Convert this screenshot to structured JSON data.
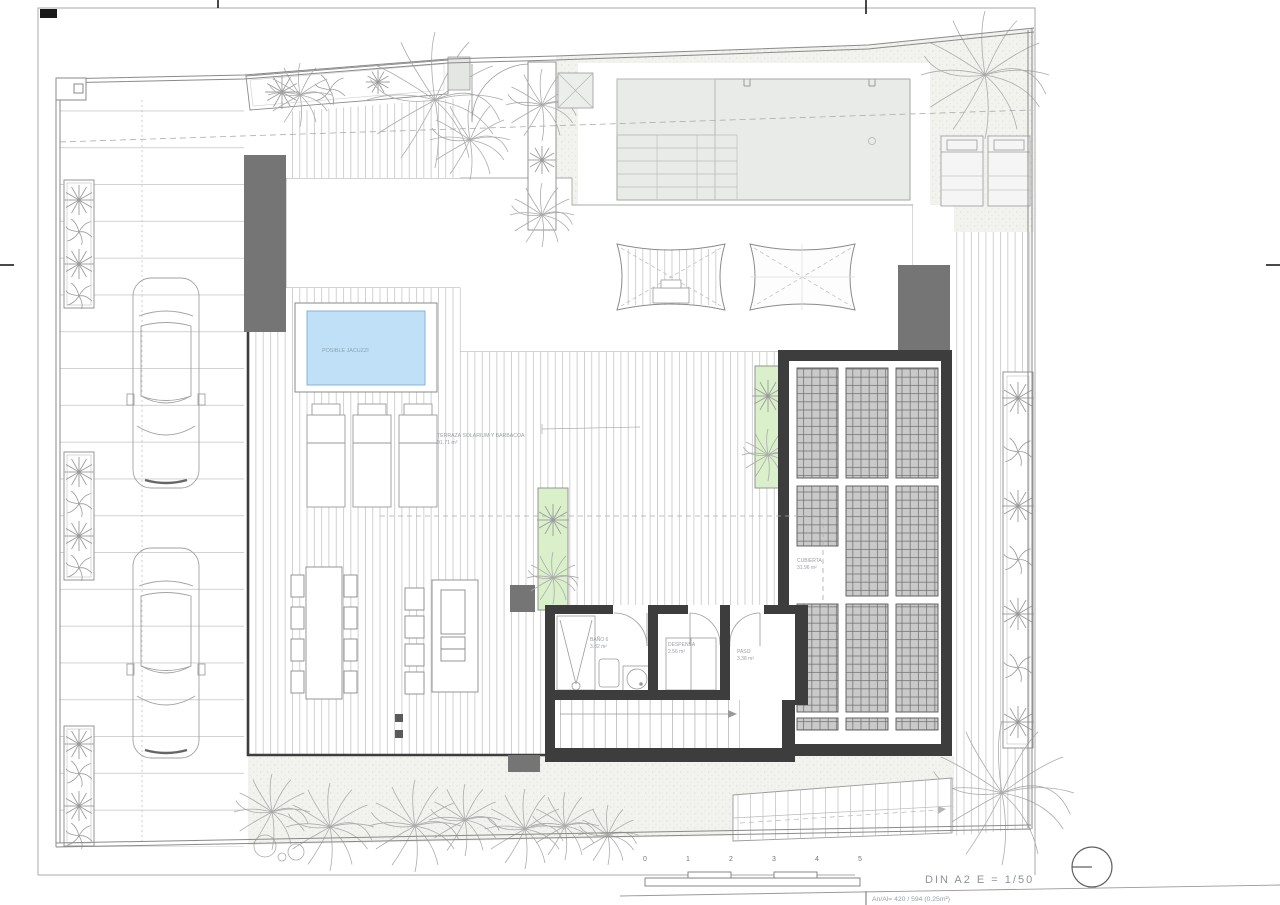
{
  "labels": {
    "jacuzzi": "POSIBLE JACUZZI",
    "terrace_name": "TERRAZA SOLARIUM Y BARBACOA",
    "terrace_area": "91.71 m²",
    "bathroom_name": "BAÑO 6",
    "bathroom_area": "3.82 m²",
    "pantry_name": "DESPENSA",
    "pantry_area": "2.56 m²",
    "hall_name": "PASO",
    "hall_area": "3.38 m²",
    "roof_name": "CUBIERTA",
    "roof_area": "31.96 m²"
  },
  "title_block": {
    "format_scale": "DIN A2  E = 1/50",
    "size_note": "An/Al= 420 / 594 (0.25m²)"
  },
  "scale_bar": {
    "ticks": [
      "0",
      "1",
      "2",
      "3",
      "4",
      "5"
    ]
  },
  "colors": {
    "jacuzzi_water": "#bfe0f7",
    "planter_green": "#daf0cb",
    "wall_dark": "#3d3d3d",
    "wall_gray": "#757575",
    "panel_gray": "#cacaca",
    "pool_gray": "#e9ebe9",
    "stipple_base": "#f2f2ef"
  }
}
